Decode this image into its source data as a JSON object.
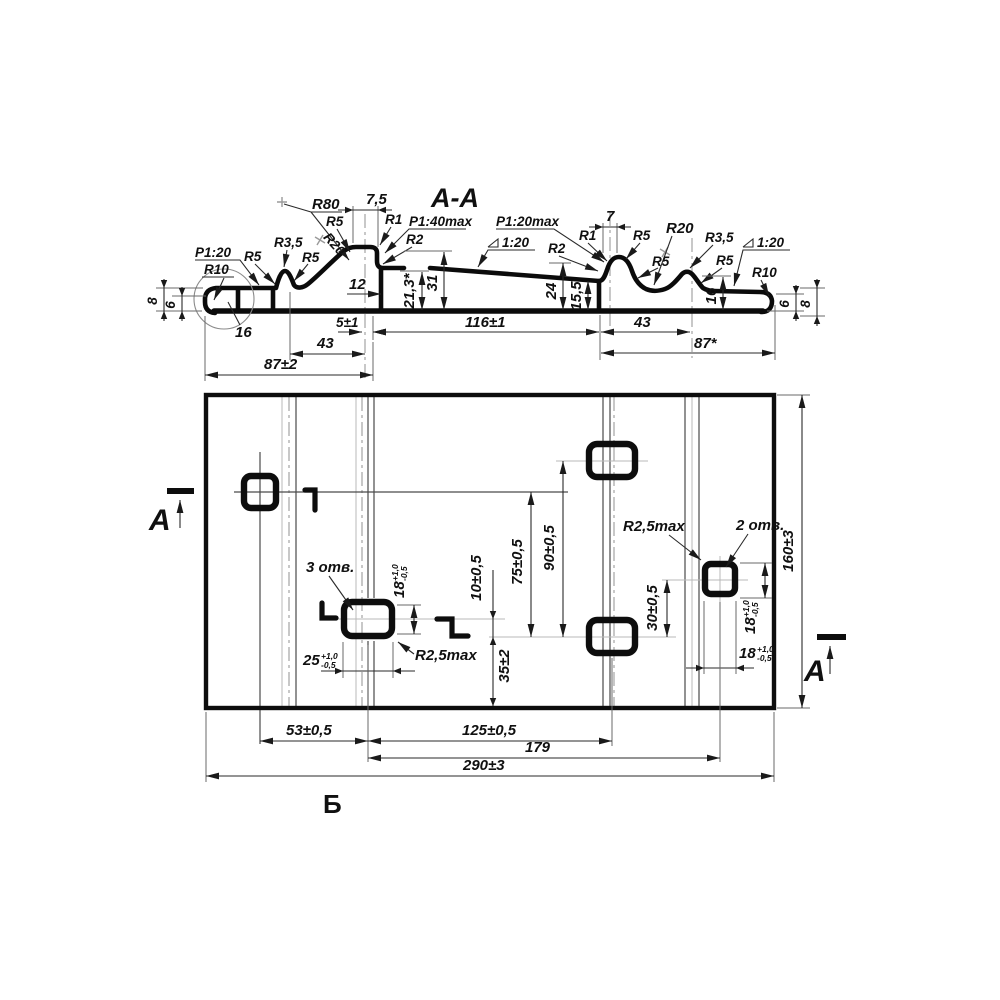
{
  "drawing": {
    "section": {
      "title": "A-A",
      "radii": {
        "r80": "R80",
        "r20": "R20",
        "r10": "R10",
        "r5": "R5",
        "r35": "R3,5",
        "r1": "R1",
        "r2": "R2"
      },
      "slopes": {
        "p120": "P1:20",
        "p140max": "P1:40max",
        "p120max": "P1:20max",
        "s120": "1:20"
      },
      "dims": {
        "w7_5": "7,5",
        "w12": "12",
        "h21_3": "21,3*",
        "h31": "31",
        "h24": "24",
        "h15_5": "15,5",
        "h16": "16",
        "h8": "8",
        "h6": "6",
        "w5": "5±1",
        "w43": "43",
        "w87": "87±2",
        "w87s": "87*",
        "w116": "116±1",
        "w7": "7"
      }
    },
    "plan": {
      "cut_letter": "A",
      "view_label": "Б",
      "notes": {
        "three_holes": "3 отв.",
        "two_holes": "2 отв.",
        "r25max": "R2,5max"
      },
      "dims": {
        "w53": "53±0,5",
        "w125": "125±0,5",
        "w179": "179",
        "w290": "290±3",
        "h160": "160±3",
        "h75": "75±0,5",
        "h90": "90±0,5",
        "h10": "10±0,5",
        "h35": "35±2",
        "h30": "30±0,5",
        "w25": "25",
        "w18": "18"
      },
      "tol": {
        "plus": "+1,0",
        "minus": "-0,5"
      }
    }
  }
}
